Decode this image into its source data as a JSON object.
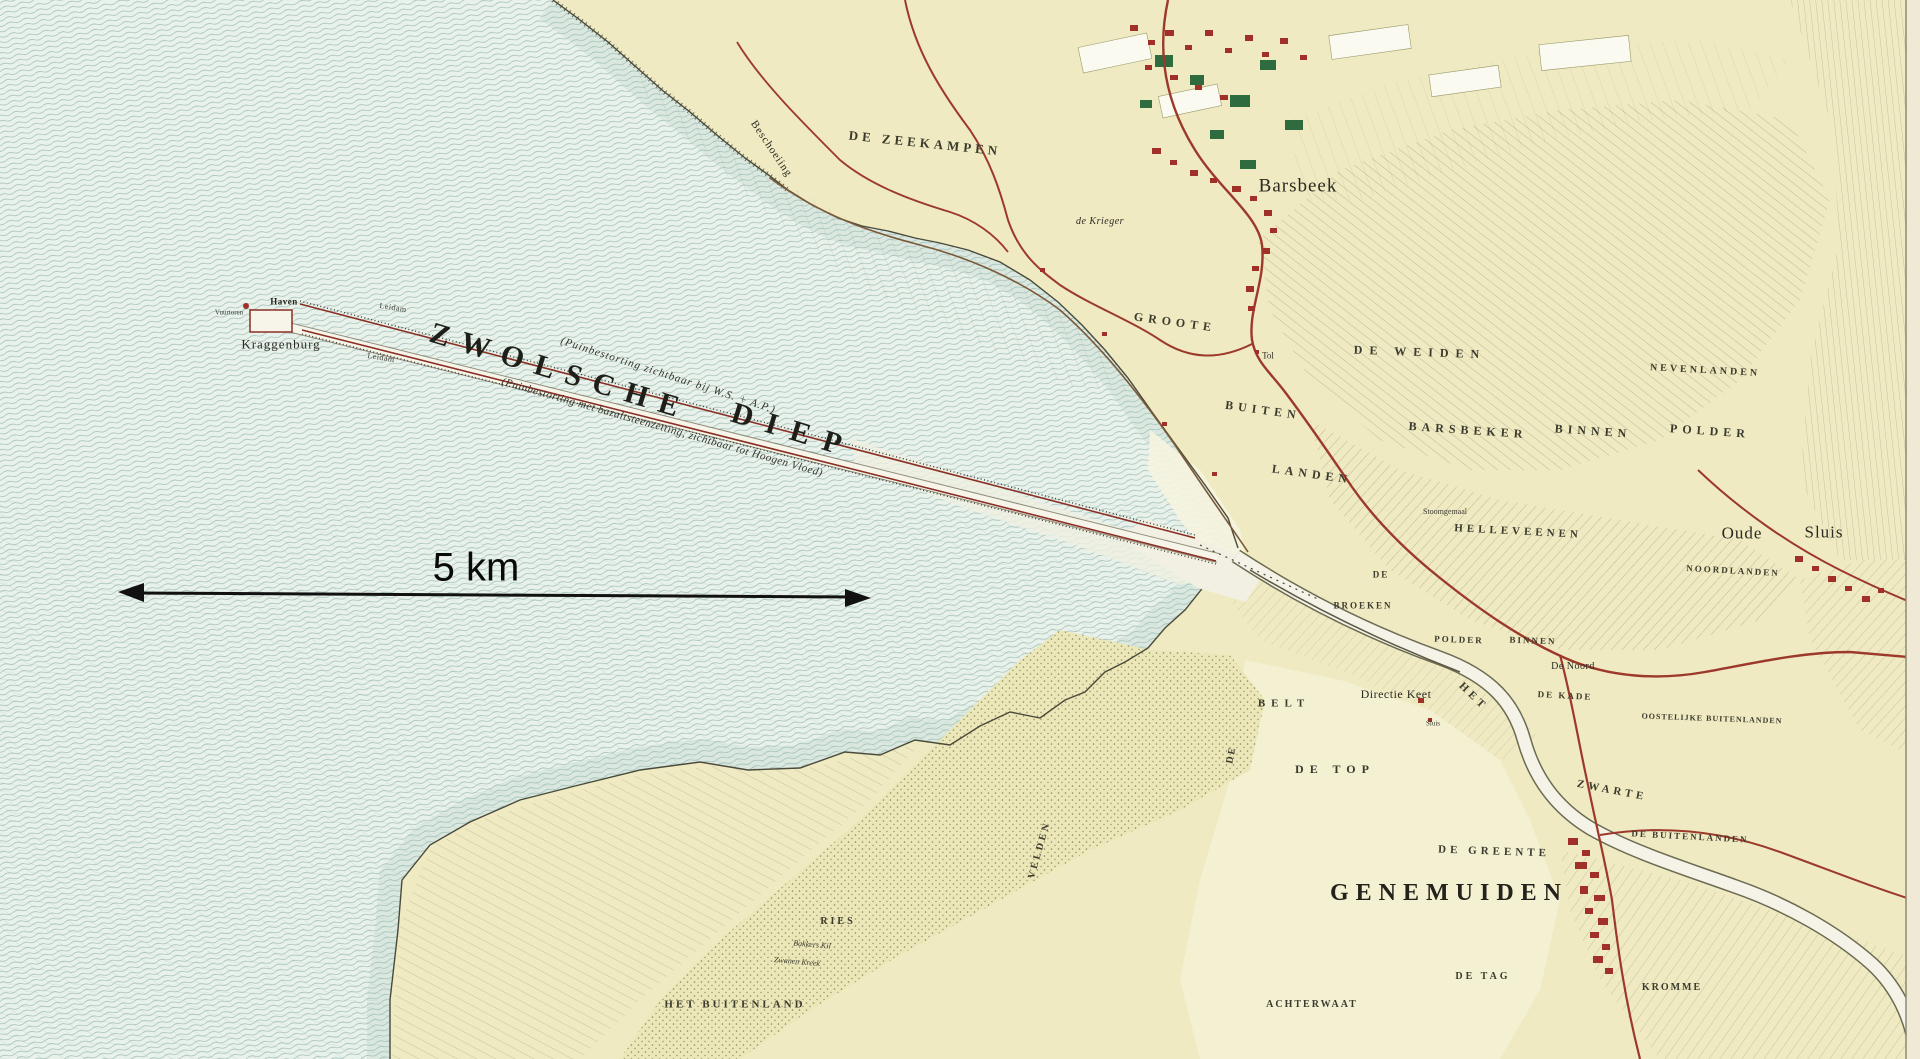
{
  "annotation": {
    "scale_text": "5 km"
  },
  "colors": {
    "water": "#e9f1eb",
    "wave_line": "#7fa89e",
    "land": "#efeac2",
    "light_field": "#f4f1d3",
    "road_red": "#9c392b",
    "town_red": "#a03028",
    "wood_green": "#2e6b3e",
    "river_white": "#f5f3e7",
    "ink": "#2b2b22"
  },
  "map_labels": [
    {
      "text": "ZWOLSCHE",
      "x": 560,
      "y": 372,
      "rot": 17,
      "fs": 30,
      "ls": 12,
      "cls": "water-name"
    },
    {
      "text": "DIEP",
      "x": 793,
      "y": 431,
      "rot": 17,
      "fs": 30,
      "ls": 14,
      "cls": "water-name"
    },
    {
      "text": "(Puinbestorting zichtbaar bij W.S. + A.P.)",
      "x": 668,
      "y": 376,
      "rot": 18,
      "fs": 11,
      "ls": 1,
      "cls": "note"
    },
    {
      "text": "(Puinbestorting met bazaltsteenzetting, zichtbaar tot Hoogen Vloed)",
      "x": 662,
      "y": 428,
      "rot": 16,
      "fs": 11,
      "ls": 0.5,
      "cls": "note"
    },
    {
      "text": "Kraggenburg",
      "x": 281,
      "y": 344,
      "rot": 0,
      "fs": 13,
      "ls": 1,
      "cls": "place"
    },
    {
      "text": "Haven",
      "x": 284,
      "y": 302,
      "rot": 0,
      "fs": 9,
      "ls": 0.5,
      "cls": "place-bold"
    },
    {
      "text": "Vuurtoren",
      "x": 229,
      "y": 313,
      "rot": 0,
      "fs": 7,
      "ls": 0,
      "cls": "tiny"
    },
    {
      "text": "Leidam",
      "x": 393,
      "y": 308,
      "rot": 9,
      "fs": 8,
      "ls": 0.5,
      "cls": "tiny"
    },
    {
      "text": "Leidam",
      "x": 381,
      "y": 358,
      "rot": 9,
      "fs": 8,
      "ls": 0.5,
      "cls": "tiny"
    },
    {
      "text": "Beschoeiing",
      "x": 771,
      "y": 149,
      "rot": 56,
      "fs": 11,
      "ls": 1,
      "cls": "place"
    },
    {
      "text": "DE ZEEKAMPEN",
      "x": 925,
      "y": 143,
      "rot": 6,
      "fs": 13,
      "ls": 4,
      "cls": "area"
    },
    {
      "text": "Barsbeek",
      "x": 1298,
      "y": 186,
      "rot": 0,
      "fs": 19,
      "ls": 1,
      "cls": "place"
    },
    {
      "text": "de Krieger",
      "x": 1100,
      "y": 222,
      "rot": 0,
      "fs": 10,
      "ls": 0.5,
      "cls": "place-italic"
    },
    {
      "text": "GROOTE",
      "x": 1175,
      "y": 322,
      "rot": 8,
      "fs": 12,
      "ls": 5,
      "cls": "area"
    },
    {
      "text": "BUITEN",
      "x": 1263,
      "y": 410,
      "rot": 8,
      "fs": 12,
      "ls": 5,
      "cls": "area"
    },
    {
      "text": "LANDEN",
      "x": 1312,
      "y": 474,
      "rot": 8,
      "fs": 12,
      "ls": 5,
      "cls": "area"
    },
    {
      "text": "Tol",
      "x": 1268,
      "y": 356,
      "rot": 0,
      "fs": 9,
      "ls": 0,
      "cls": "place"
    },
    {
      "text": "DE WEIDEN",
      "x": 1420,
      "y": 352,
      "rot": 2,
      "fs": 12,
      "ls": 7,
      "cls": "area"
    },
    {
      "text": "NEVENLANDEN",
      "x": 1705,
      "y": 371,
      "rot": 3,
      "fs": 10,
      "ls": 3,
      "cls": "area"
    },
    {
      "text": "BARSBEKER",
      "x": 1468,
      "y": 430,
      "rot": 4,
      "fs": 12,
      "ls": 5,
      "cls": "area"
    },
    {
      "text": "BINNEN",
      "x": 1593,
      "y": 431,
      "rot": 4,
      "fs": 12,
      "ls": 5,
      "cls": "area"
    },
    {
      "text": "POLDER",
      "x": 1710,
      "y": 431,
      "rot": 4,
      "fs": 12,
      "ls": 5,
      "cls": "area"
    },
    {
      "text": "HELLEVEENEN",
      "x": 1518,
      "y": 532,
      "rot": 3,
      "fs": 11,
      "ls": 4,
      "cls": "area"
    },
    {
      "text": "Oude",
      "x": 1742,
      "y": 533,
      "rot": 0,
      "fs": 17,
      "ls": 1,
      "cls": "place"
    },
    {
      "text": "Sluis",
      "x": 1824,
      "y": 532,
      "rot": 0,
      "fs": 17,
      "ls": 1,
      "cls": "place"
    },
    {
      "text": "NOORDLANDEN",
      "x": 1733,
      "y": 571,
      "rot": 3,
      "fs": 9,
      "ls": 2,
      "cls": "area"
    },
    {
      "text": "Stoomgemaal",
      "x": 1445,
      "y": 512,
      "rot": 0,
      "fs": 8,
      "ls": 0,
      "cls": "tiny"
    },
    {
      "text": "DE",
      "x": 1381,
      "y": 575,
      "rot": 0,
      "fs": 9,
      "ls": 2,
      "cls": "area"
    },
    {
      "text": "BROEKEN",
      "x": 1363,
      "y": 606,
      "rot": 0,
      "fs": 9,
      "ls": 2,
      "cls": "area"
    },
    {
      "text": "POLDER",
      "x": 1459,
      "y": 640,
      "rot": 2,
      "fs": 9,
      "ls": 2,
      "cls": "area"
    },
    {
      "text": "BINNEN",
      "x": 1533,
      "y": 641,
      "rot": 2,
      "fs": 9,
      "ls": 2,
      "cls": "area"
    },
    {
      "text": "De Noord",
      "x": 1573,
      "y": 667,
      "rot": 0,
      "fs": 10,
      "ls": 0.5,
      "cls": "place"
    },
    {
      "text": "DE KADE",
      "x": 1565,
      "y": 696,
      "rot": 3,
      "fs": 9,
      "ls": 2,
      "cls": "area"
    },
    {
      "text": "OOSTELIJKE BUITENLANDEN",
      "x": 1712,
      "y": 719,
      "rot": 2,
      "fs": 8,
      "ls": 1,
      "cls": "area"
    },
    {
      "text": "Directie Keet",
      "x": 1396,
      "y": 694,
      "rot": 0,
      "fs": 12,
      "ls": 0.5,
      "cls": "place"
    },
    {
      "text": "Sluis",
      "x": 1433,
      "y": 724,
      "rot": 0,
      "fs": 7,
      "ls": 0,
      "cls": "tiny"
    },
    {
      "text": "HET",
      "x": 1473,
      "y": 697,
      "rot": 44,
      "fs": 11,
      "ls": 4,
      "cls": "area"
    },
    {
      "text": "ZWARTE",
      "x": 1612,
      "y": 791,
      "rot": 11,
      "fs": 11,
      "ls": 4,
      "cls": "area"
    },
    {
      "text": "BELT",
      "x": 1284,
      "y": 704,
      "rot": 0,
      "fs": 11,
      "ls": 6,
      "cls": "area"
    },
    {
      "text": "DE",
      "x": 1232,
      "y": 755,
      "rot": -78,
      "fs": 10,
      "ls": 2,
      "cls": "area"
    },
    {
      "text": "DE TOP",
      "x": 1335,
      "y": 769,
      "rot": 0,
      "fs": 12,
      "ls": 6,
      "cls": "area"
    },
    {
      "text": "DE GREENTE",
      "x": 1494,
      "y": 852,
      "rot": 2,
      "fs": 11,
      "ls": 4,
      "cls": "area"
    },
    {
      "text": "GENEMUIDEN",
      "x": 1449,
      "y": 893,
      "rot": 0,
      "fs": 24,
      "ls": 7,
      "cls": "town"
    },
    {
      "text": "DE BUITENLANDEN",
      "x": 1690,
      "y": 837,
      "rot": 3,
      "fs": 9,
      "ls": 2,
      "cls": "area"
    },
    {
      "text": "DE TAG",
      "x": 1483,
      "y": 977,
      "rot": 0,
      "fs": 10,
      "ls": 3,
      "cls": "area"
    },
    {
      "text": "ACHTERWAAT",
      "x": 1312,
      "y": 1005,
      "rot": 0,
      "fs": 10,
      "ls": 2,
      "cls": "area"
    },
    {
      "text": "KROMME",
      "x": 1672,
      "y": 988,
      "rot": 0,
      "fs": 10,
      "ls": 2,
      "cls": "area"
    },
    {
      "text": "HET BUITENLAND",
      "x": 735,
      "y": 1005,
      "rot": 0,
      "fs": 11,
      "ls": 3,
      "cls": "area"
    },
    {
      "text": "RIES",
      "x": 838,
      "y": 922,
      "rot": 0,
      "fs": 10,
      "ls": 3,
      "cls": "area"
    },
    {
      "text": "VELDEN",
      "x": 1040,
      "y": 850,
      "rot": -74,
      "fs": 10,
      "ls": 3,
      "cls": "area"
    },
    {
      "text": "Bakkers Kil",
      "x": 812,
      "y": 945,
      "rot": 5,
      "fs": 8,
      "ls": 0,
      "cls": "tiny-italic"
    },
    {
      "text": "Zwanen Kreek",
      "x": 797,
      "y": 962,
      "rot": 5,
      "fs": 8,
      "ls": 0,
      "cls": "tiny-italic"
    }
  ]
}
